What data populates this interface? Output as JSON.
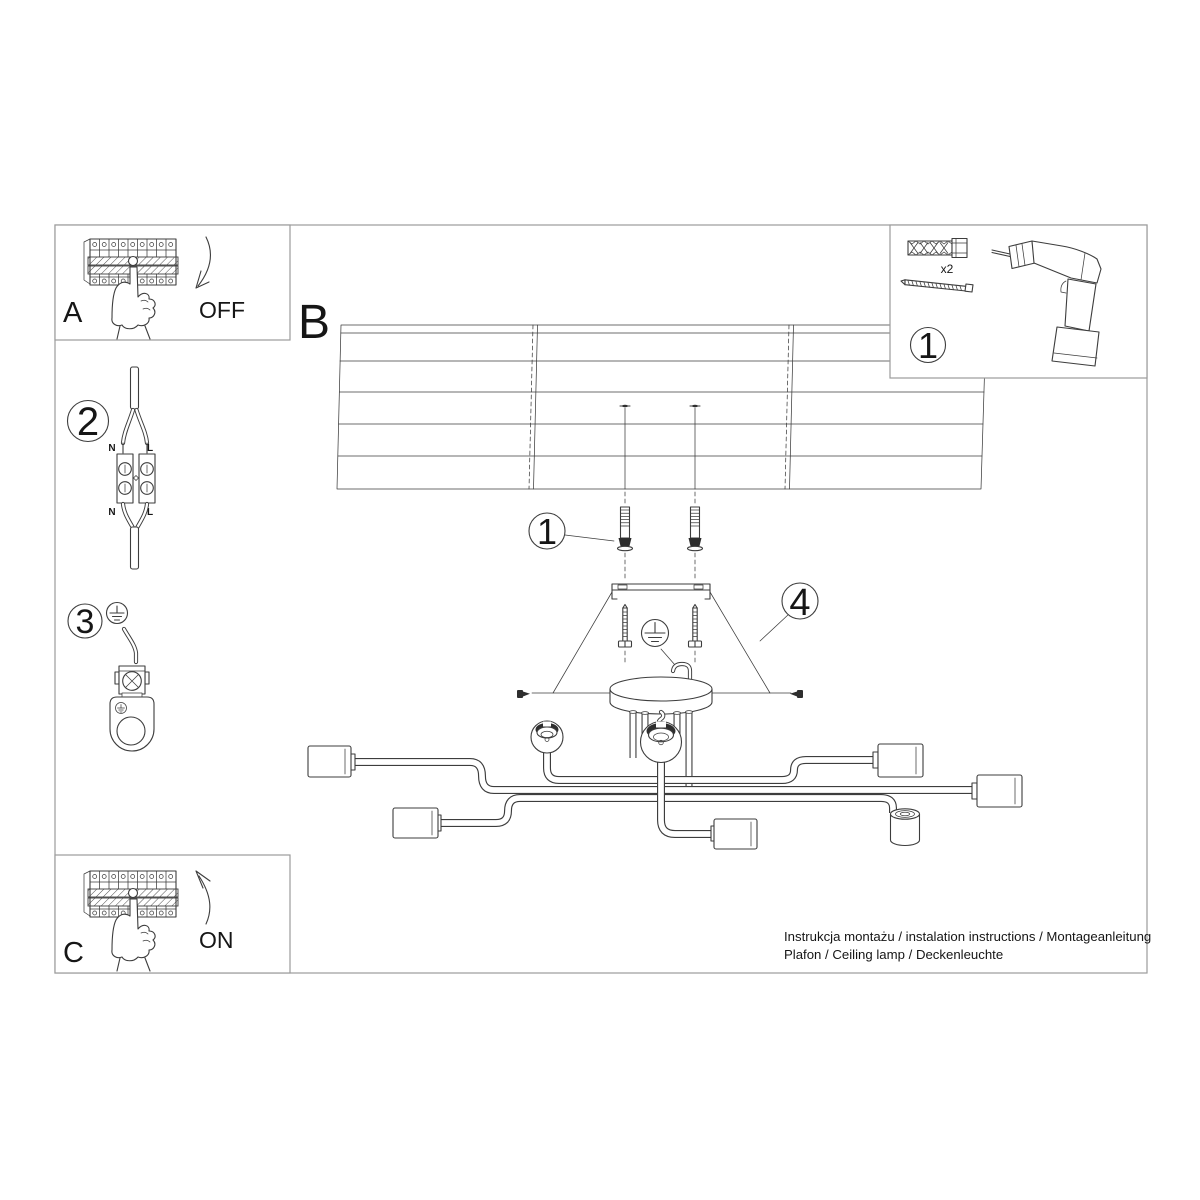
{
  "colors": {
    "line": "#3d3d3d",
    "frame": "#9b9b9b",
    "background": "#ffffff",
    "shading": "#2e2e2e"
  },
  "steps": {
    "a": {
      "label": "A",
      "switch_state": "OFF"
    },
    "b": {
      "label": "B"
    },
    "c": {
      "label": "C",
      "switch_state": "ON"
    }
  },
  "callouts": {
    "parts_box": "1",
    "wall_plug": "1",
    "wire_connector": "2",
    "ground_wire": "3",
    "canopy_screws": "4"
  },
  "parts_box": {
    "plug_quantity": "x2"
  },
  "wiring": {
    "top": {
      "neutral": "N",
      "live": "L"
    },
    "bottom": {
      "neutral": "N",
      "live": "L"
    }
  },
  "caption": {
    "line1": "Instrukcja montażu / instalation instructions / Montageanleitung",
    "line2": "Plafon / Ceiling lamp / Deckenleuchte"
  }
}
